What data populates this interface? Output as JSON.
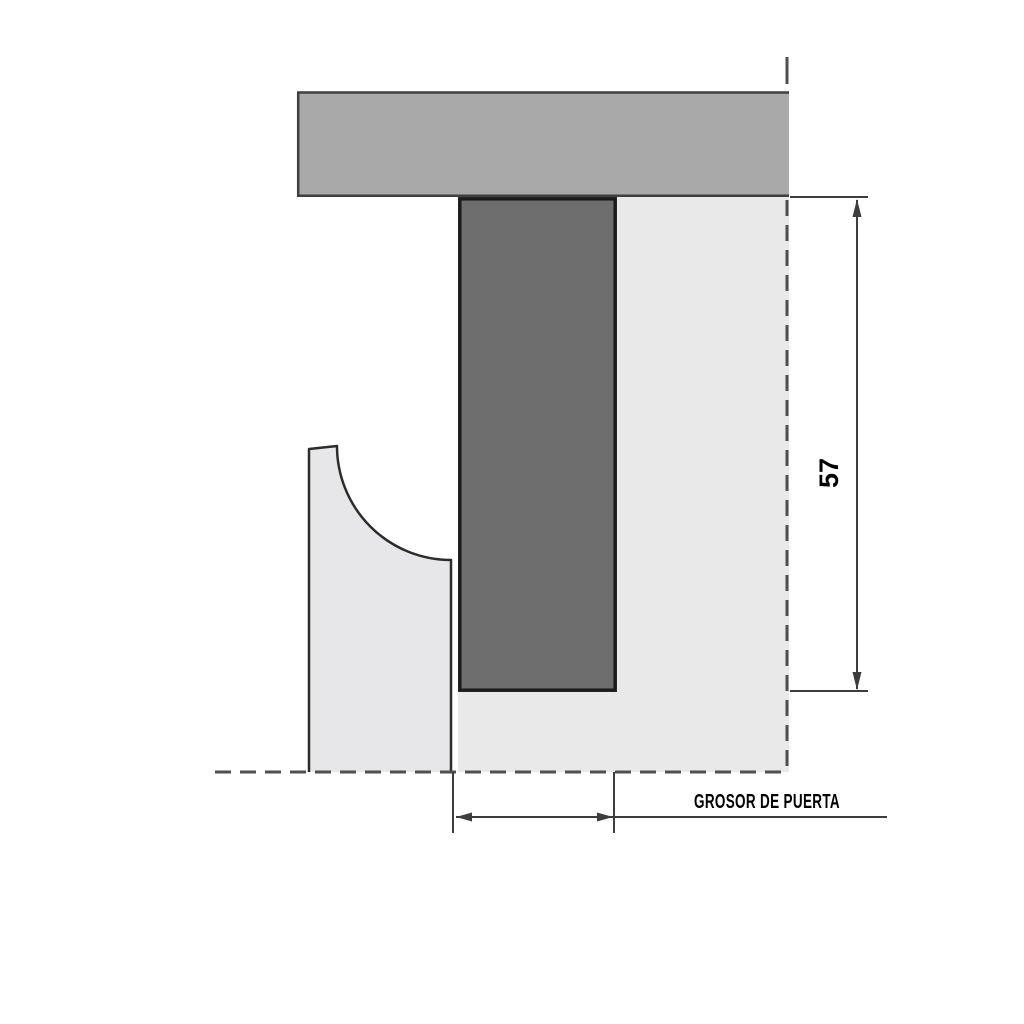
{
  "diagram": {
    "labels": {
      "height_dimension": "57",
      "thickness_dimension": "GROSOR DE PUERTA"
    },
    "colors": {
      "top_frame": "#a9a9a9",
      "door_core": "#6e6e6e",
      "panel_light": "#e9e9e9",
      "molding": "#e7e7e9",
      "dimension_line": "#3d3d3d",
      "dashed_line": "#4f4f4f"
    }
  }
}
